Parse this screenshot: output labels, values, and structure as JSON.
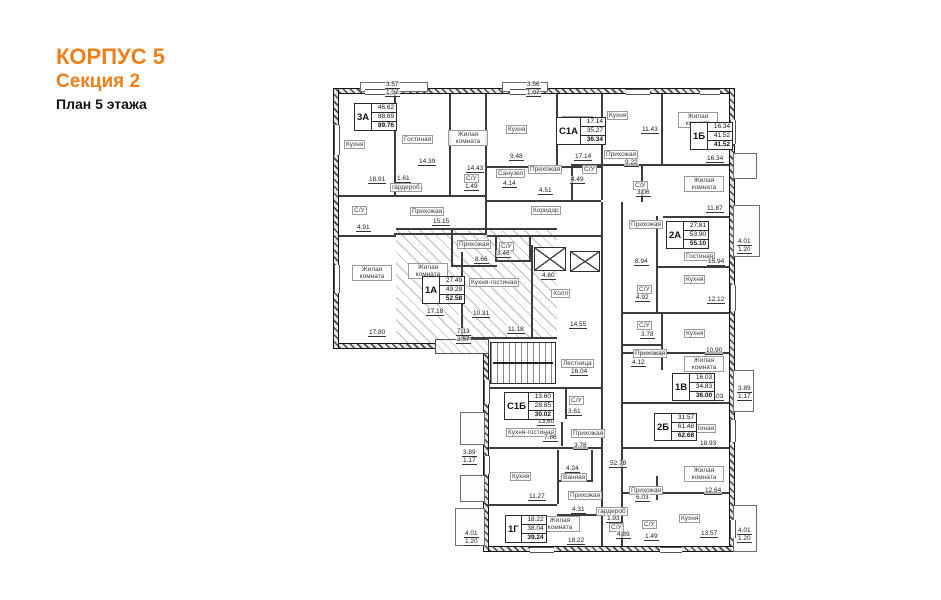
{
  "title": {
    "building": "КОРПУС 5",
    "section": "Секция 2",
    "floor": "План 5 этажа"
  },
  "colors": {
    "accent": "#ef7e1b",
    "wall": "#1c1c1c"
  },
  "apartments": [
    {
      "code": "3А",
      "values": [
        "46.62",
        "88.69",
        "89.76"
      ],
      "x": 24,
      "y": 23
    },
    {
      "code": "С1А",
      "values": [
        "17.14",
        "35.27",
        "36.34"
      ],
      "x": 226,
      "y": 37
    },
    {
      "code": "1Б",
      "values": [
        "16.34",
        "41.52",
        "41.52"
      ],
      "x": 360,
      "y": 42
    },
    {
      "code": "1А",
      "values": [
        "27.49",
        "49.29",
        "52.58"
      ],
      "x": 92,
      "y": 196
    },
    {
      "code": "2А",
      "values": [
        "27.81",
        "53.90",
        "55.10"
      ],
      "x": 336,
      "y": 141
    },
    {
      "code": "1В",
      "values": [
        "16.03",
        "34.83",
        "36.00"
      ],
      "x": 342,
      "y": 293
    },
    {
      "code": "2Б",
      "values": [
        "31.57",
        "61.48",
        "62.68"
      ],
      "x": 324,
      "y": 333
    },
    {
      "code": "С1Б",
      "values": [
        "13.60",
        "28.85",
        "30.02"
      ],
      "x": 174,
      "y": 312
    },
    {
      "code": "1Г",
      "values": [
        "18.22",
        "38.04",
        "39.24"
      ],
      "x": 175,
      "y": 435
    }
  ],
  "rooms": [
    {
      "label": "Кухня",
      "x": 14,
      "y": 60,
      "area": "18.91",
      "ax": 38,
      "ay": 96
    },
    {
      "label": "Гостиная",
      "x": 72,
      "y": 55,
      "area": "14.39",
      "ax": 88,
      "ay": 78
    },
    {
      "label": "Жилая комната",
      "x": 118,
      "y": 50,
      "w": 36,
      "area": "14.43",
      "ax": 136,
      "ay": 85
    },
    {
      "label": "гардероб",
      "x": 60,
      "y": 103,
      "area": "1.61",
      "ax": 66,
      "ay": 95
    },
    {
      "label": "С/У",
      "x": 134,
      "y": 94,
      "area": "1.49",
      "ax": 134,
      "ay": 103
    },
    {
      "label": "С/У",
      "x": 22,
      "y": 126,
      "area": "4.91",
      "ax": 26,
      "ay": 144
    },
    {
      "label": "Прихожая",
      "x": 80,
      "y": 127,
      "area": "15.15",
      "ax": 102,
      "ay": 138
    },
    {
      "label": "Жилая комната",
      "x": 22,
      "y": 185,
      "w": 36,
      "area": "17.80",
      "ax": 38,
      "ay": 249
    },
    {
      "label": "Кухня",
      "x": 176,
      "y": 45,
      "area": "9.48",
      "ax": 179,
      "ay": 73
    },
    {
      "label": "Санузел",
      "x": 166,
      "y": 89,
      "area": "4.14",
      "ax": 172,
      "ay": 100
    },
    {
      "label": "Прихожая",
      "x": 198,
      "y": 85,
      "area": "4.51",
      "ax": 208,
      "ay": 107
    },
    {
      "label": "Гостиная",
      "x": 232,
      "y": 36,
      "area": "17.14",
      "ax": 244,
      "ay": 73
    },
    {
      "label": "Кухня",
      "x": 277,
      "y": 31,
      "area": "11.43",
      "ax": 311,
      "ay": 46
    },
    {
      "label": "Жилая комната",
      "x": 348,
      "y": 32,
      "w": 36,
      "area": "16.34",
      "ax": 376,
      "ay": 75
    },
    {
      "label": "С/У",
      "x": 252,
      "y": 85,
      "area": "4.49",
      "ax": 240,
      "ay": 96
    },
    {
      "label": "Прихожая",
      "x": 274,
      "y": 70,
      "area": "9.22",
      "ax": 294,
      "ay": 79
    },
    {
      "label": "С/У",
      "x": 303,
      "y": 101,
      "area": "3.06",
      "ax": 306,
      "ay": 109
    },
    {
      "label": "Жилая комната",
      "x": 354,
      "y": 96,
      "w": 36,
      "area": "11.87",
      "ax": 376,
      "ay": 125
    },
    {
      "label": "Прихожая",
      "x": 299,
      "y": 140,
      "area": "8.94",
      "ax": 304,
      "ay": 178
    },
    {
      "label": "Гостиная",
      "x": 354,
      "y": 172,
      "area": "15.94",
      "ax": 377,
      "ay": 178
    },
    {
      "label": "Кухня",
      "x": 354,
      "y": 195,
      "area": "12.12",
      "ax": 377,
      "ay": 216
    },
    {
      "label": "С/У",
      "x": 307,
      "y": 205,
      "area": "4.92",
      "ax": 305,
      "ay": 214
    },
    {
      "label": "С/У",
      "x": 307,
      "y": 241,
      "area": "3.78",
      "ax": 310,
      "ay": 251
    },
    {
      "label": "Кухня",
      "x": 354,
      "y": 249,
      "area": "10.90",
      "ax": 375,
      "ay": 267
    },
    {
      "label": "Прихожая",
      "x": 303,
      "y": 269,
      "area": "4.12",
      "ax": 301,
      "ay": 279
    },
    {
      "label": "Жилая комната",
      "x": 354,
      "y": 276,
      "w": 36,
      "area": "16.03",
      "ax": 376,
      "ay": 313
    },
    {
      "label": "Гостиная",
      "x": 355,
      "y": 344,
      "area": "18.93",
      "ax": 369,
      "ay": 360
    },
    {
      "label": "Жилая комната",
      "x": 354,
      "y": 386,
      "w": 36,
      "area": "12.64",
      "ax": 374,
      "ay": 407
    },
    {
      "label": "Кухня",
      "x": 349,
      "y": 434,
      "area": "13.57",
      "ax": 370,
      "ay": 450
    },
    {
      "label": "Прихожая",
      "x": 299,
      "y": 406,
      "area": "6.03",
      "ax": 305,
      "ay": 414
    },
    {
      "label": "гардероб",
      "x": 266,
      "y": 427,
      "area": "1.93",
      "ax": 276,
      "ay": 435
    },
    {
      "label": "С/У",
      "x": 279,
      "y": 443,
      "area": "4.89",
      "ax": 286,
      "ay": 451
    },
    {
      "label": "С/У",
      "x": 312,
      "y": 440,
      "area": "1.49",
      "ax": 314,
      "ay": 453
    },
    {
      "label": "С/У",
      "x": 239,
      "y": 316,
      "area": "3.61",
      "ax": 237,
      "ay": 328
    },
    {
      "label": "Кухня-гостиная",
      "x": 176,
      "y": 348,
      "area": "7.86",
      "ax": 213,
      "ay": 354
    },
    {
      "label": "Прихожая",
      "x": 241,
      "y": 349,
      "area": "3.78",
      "ax": 243,
      "ay": 362
    },
    {
      "label": "Кухня",
      "x": 180,
      "y": 392,
      "area": "11.27",
      "ax": 198,
      "ay": 413
    },
    {
      "label": "Ванная",
      "x": 231,
      "y": 393,
      "area": "4.24",
      "ax": 235,
      "ay": 385
    },
    {
      "label": "Прихожая",
      "x": 238,
      "y": 411,
      "area": "4.31",
      "ax": 241,
      "ay": 426
    },
    {
      "label": "Жилая комната",
      "x": 210,
      "y": 436,
      "w": 36,
      "area": "18.22",
      "ax": 237,
      "ay": 457
    },
    {
      "label": "Прихожая",
      "x": 127,
      "y": 160,
      "area": "8.66",
      "ax": 144,
      "ay": 176
    },
    {
      "label": "С/У",
      "x": 169,
      "y": 162,
      "area": "3.46",
      "ax": 166,
      "ay": 170
    },
    {
      "label": "Жилая комната",
      "x": 78,
      "y": 183,
      "w": 36,
      "area": "17.18",
      "ax": 96,
      "ay": 228
    },
    {
      "label": "Кухня-гостиная",
      "x": 139,
      "y": 198,
      "area": "11.18",
      "ax": 177,
      "ay": 246
    },
    {
      "label": "Коридор",
      "x": 201,
      "y": 126,
      "area": ""
    },
    {
      "label": "Лестница",
      "x": 231,
      "y": 279,
      "area": "16.04",
      "ax": 240,
      "ay": 288
    },
    {
      "label": "Холл",
      "x": 221,
      "y": 209,
      "area": "14.55",
      "ax": 239,
      "ay": 241
    }
  ],
  "dimensions": [
    {
      "t": "3.57",
      "x": 55,
      "y": 1
    },
    {
      "t": "1.07",
      "x": 55,
      "y": 9
    },
    {
      "t": "3.56",
      "x": 196,
      "y": 1
    },
    {
      "t": "1.07",
      "x": 196,
      "y": 9
    },
    {
      "t": "4.01",
      "x": 407,
      "y": 158
    },
    {
      "t": "1.20",
      "x": 407,
      "y": 166
    },
    {
      "t": "3.89",
      "x": 407,
      "y": 305
    },
    {
      "t": "1.17",
      "x": 407,
      "y": 313
    },
    {
      "t": "4.01",
      "x": 407,
      "y": 447
    },
    {
      "t": "1.20",
      "x": 407,
      "y": 455
    },
    {
      "t": "3.89",
      "x": 132,
      "y": 369
    },
    {
      "t": "1.17",
      "x": 132,
      "y": 377
    },
    {
      "t": "4.01",
      "x": 134,
      "y": 450
    },
    {
      "t": "1.20",
      "x": 134,
      "y": 458
    },
    {
      "t": "52.78",
      "x": 279,
      "y": 380
    },
    {
      "t": "10.31",
      "x": 142,
      "y": 230
    },
    {
      "t": "13.60",
      "x": 207,
      "y": 338
    },
    {
      "t": "7.13",
      "x": 126,
      "y": 248
    },
    {
      "t": "3.57",
      "x": 126,
      "y": 256
    },
    {
      "t": "4.60",
      "x": 211,
      "y": 192
    }
  ]
}
